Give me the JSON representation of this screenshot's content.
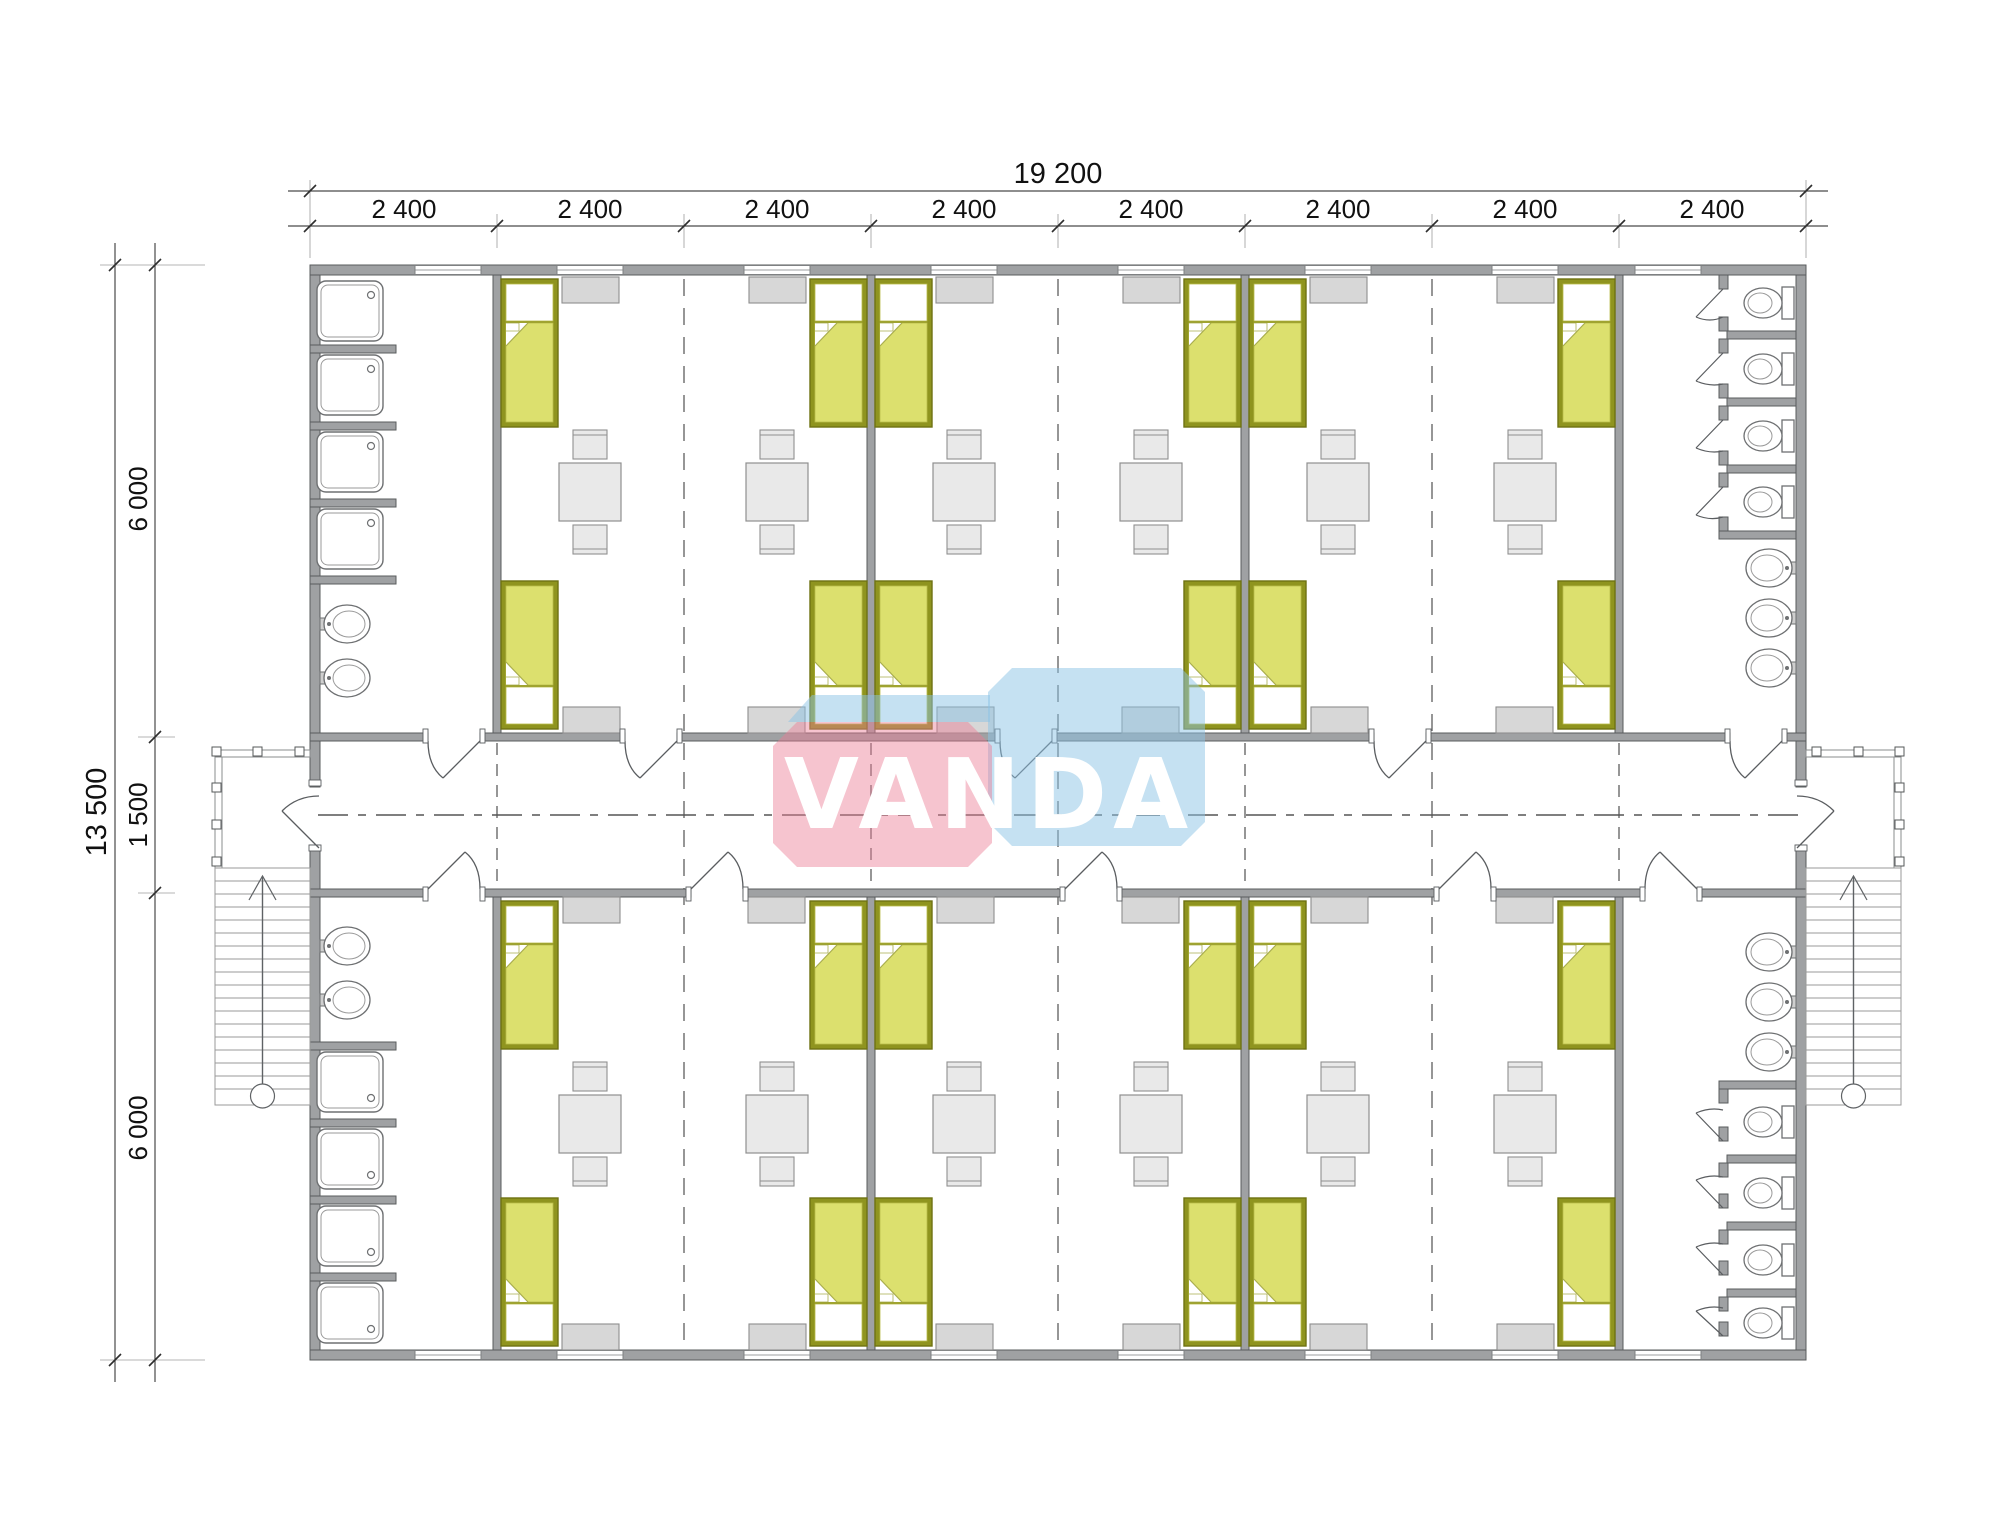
{
  "watermark": {
    "text": "VANDA",
    "pink": "#ec7d94",
    "blue": "#8bc4e5"
  },
  "dimensions": {
    "total_width": "19 200",
    "modules": [
      "2 400",
      "2 400",
      "2 400",
      "2 400",
      "2 400",
      "2 400",
      "2 400",
      "2 400"
    ],
    "total_height": "13 500",
    "height_segments": [
      "6 000",
      "1 500",
      "6 000"
    ]
  },
  "plan": {
    "type": "modular dormitory floor plan",
    "module_count": 8,
    "rooms_per_side": 3,
    "beds_per_room": 4,
    "tables_per_room": 2,
    "washroom_left": {
      "showers_top": 4,
      "sinks_top": 2,
      "showers_bottom": 4,
      "sinks_bottom": 2
    },
    "washroom_right": {
      "toilets_top": 4,
      "sinks_top": 3,
      "toilets_bottom": 4,
      "sinks_bottom": 3
    },
    "stairs": 2,
    "porches": 2
  },
  "colors": {
    "wall": "#9fa1a3",
    "bed_blanket": "#dce06e",
    "bed_frame": "#8f941f",
    "furniture_gray": "#e9e9e9",
    "cabinet_gray": "#d7d7d7"
  }
}
